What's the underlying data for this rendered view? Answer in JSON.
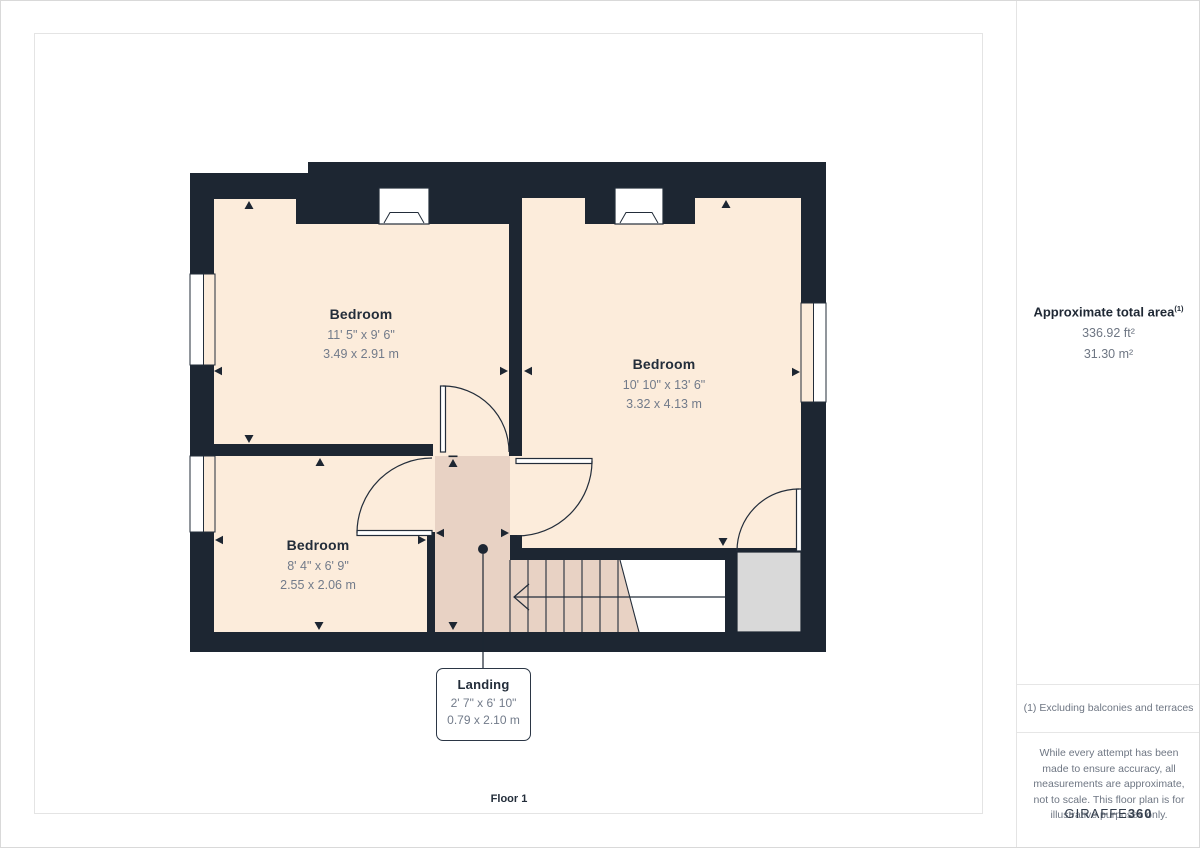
{
  "plan": {
    "floor_label": "Floor 1",
    "rooms": [
      {
        "name": "Bedroom",
        "imperial": "11' 5\" x 9' 6\"",
        "metric": "3.49 x 2.91 m"
      },
      {
        "name": "Bedroom",
        "imperial": "10' 10\" x 13' 6\"",
        "metric": "3.32 x 4.13 m"
      },
      {
        "name": "Bedroom",
        "imperial": "8' 4\" x 6' 9\"",
        "metric": "2.55 x 2.06 m"
      },
      {
        "name": "Landing",
        "imperial": "2' 7\" x 6' 10\"",
        "metric": "0.79 x 2.10 m"
      }
    ]
  },
  "sidebar": {
    "area_title": "Approximate total area",
    "area_superscript": "(1)",
    "area_ft": "336.92 ft²",
    "area_m": "31.30 m²",
    "footnote": "(1) Excluding balconies and terraces",
    "disclaimer": "While every attempt has been made to ensure accuracy, all measurements are approximate, not to scale. This floor plan is for illustrative purposes only.",
    "brand_name": "GIRAFFE",
    "brand_suffix": "360"
  },
  "colors": {
    "wall": "#1d2632",
    "room_fill": "#fcecdb",
    "landing_fill": "#e8d2c4",
    "cupboard_fill": "#d9d9d9",
    "line": "#232d3a",
    "dim_text": "#727b8a",
    "name_text": "#232d3a"
  }
}
